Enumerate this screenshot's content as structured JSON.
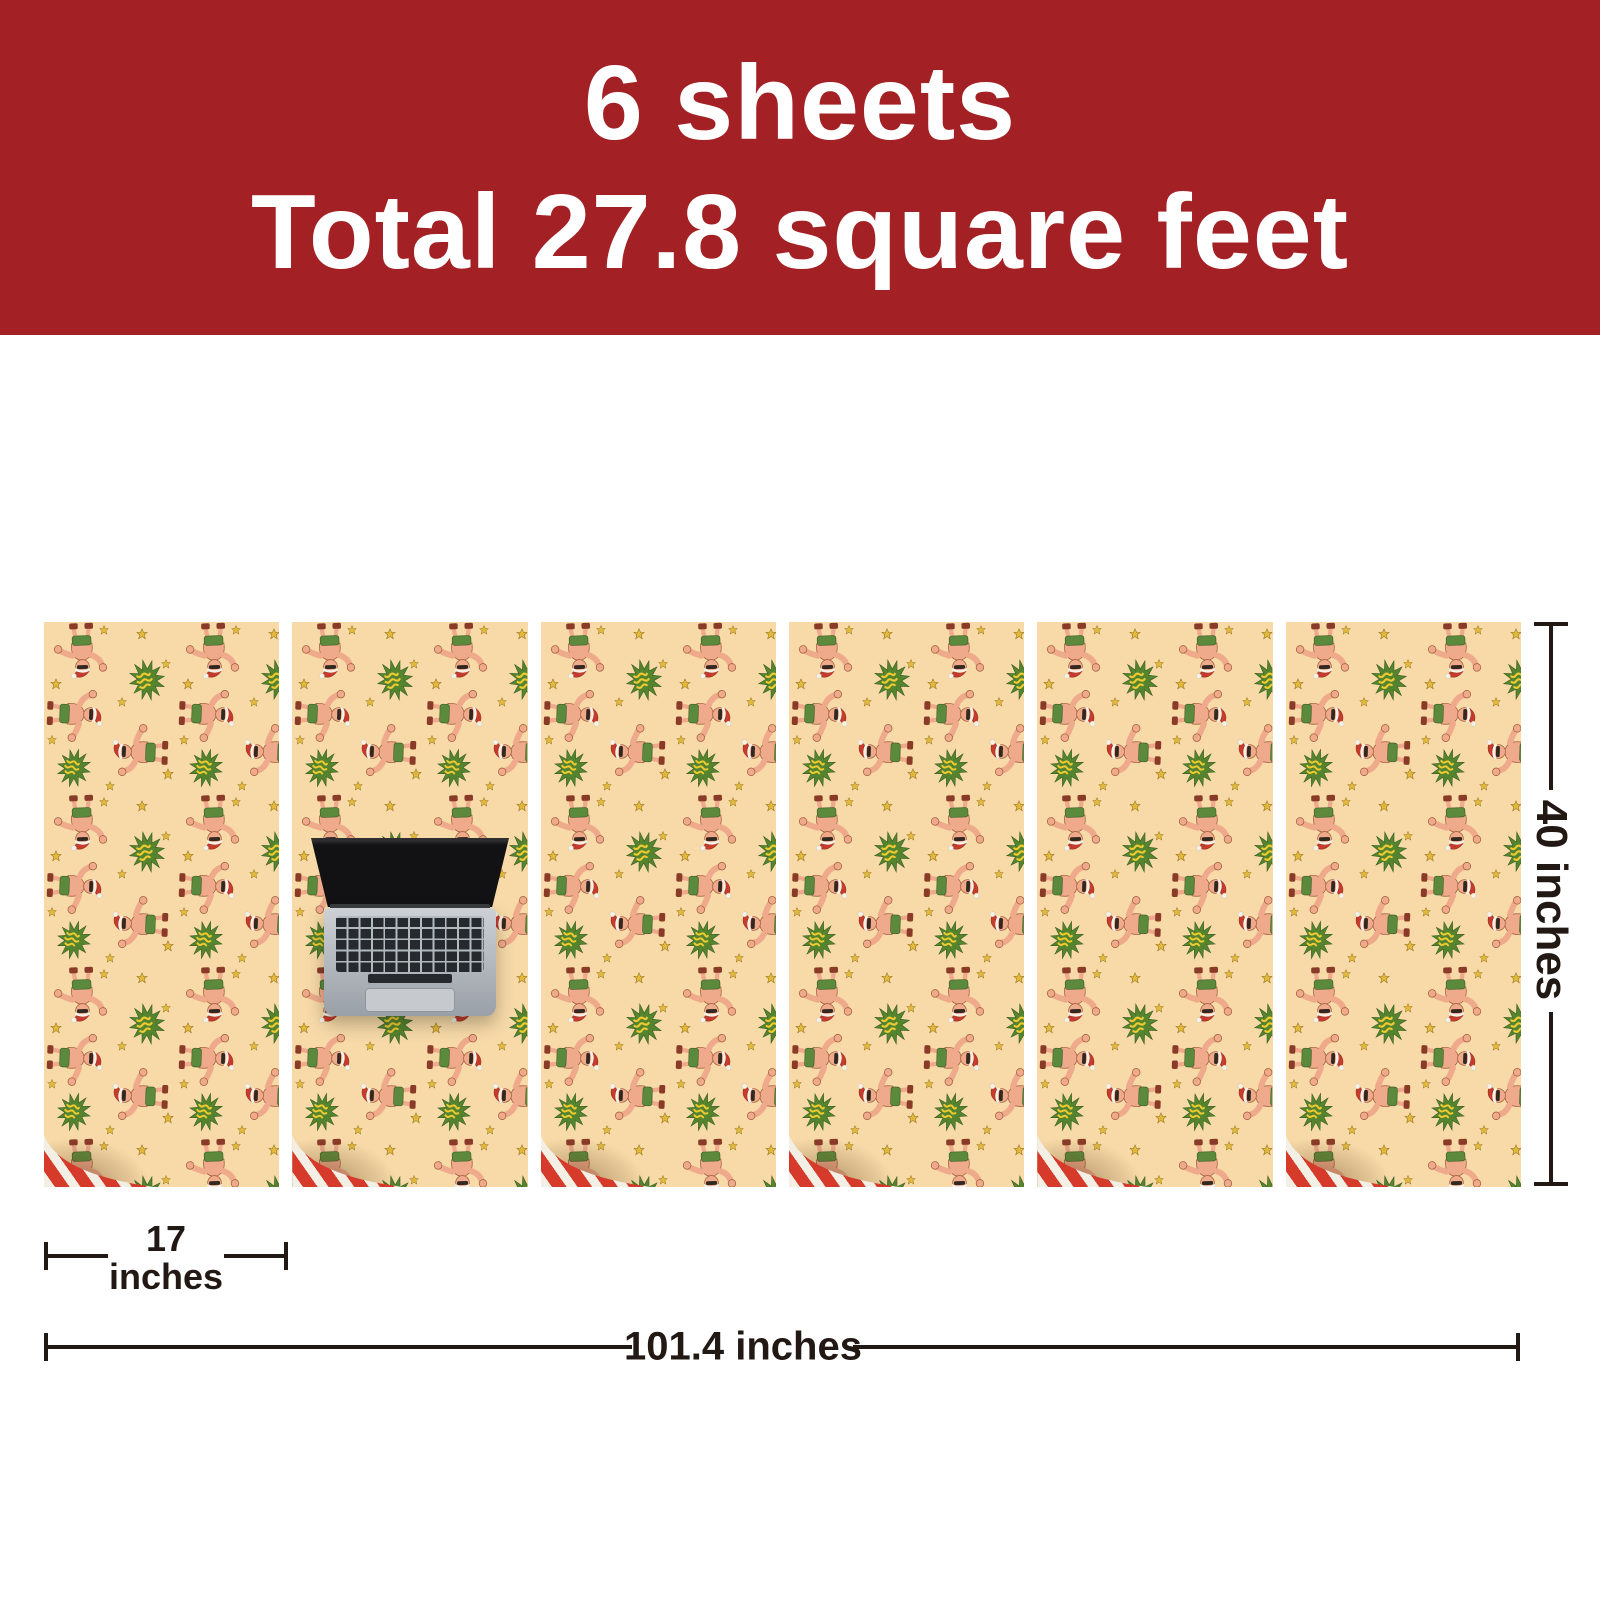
{
  "banner": {
    "line1": "6 sheets",
    "line2": "Total 27.8 square feet",
    "background_color": "#A32125",
    "text_color": "#FFFFFF"
  },
  "sheets": {
    "count": 6,
    "pattern_name": "christmas-muscle-man-santa-gift-wrap",
    "paper_color": "#F7DAA8",
    "pattern_colors": {
      "skin": "#EFAA8C",
      "santa_hat_red": "#C73B2C",
      "trunks_green": "#5C8A3C",
      "starburst_green": "#55842F",
      "star_yellow": "#E2B93B"
    },
    "backside_stripe_colors": [
      "#D53A2B",
      "#F3EFE4"
    ]
  },
  "scale_reference": {
    "object": "laptop"
  },
  "annotations": {
    "height_label": "40 inches",
    "width_label_line1": "17",
    "width_label_line2": "inches",
    "total_length_label": "101.4 inches",
    "line_color": "#221814"
  }
}
